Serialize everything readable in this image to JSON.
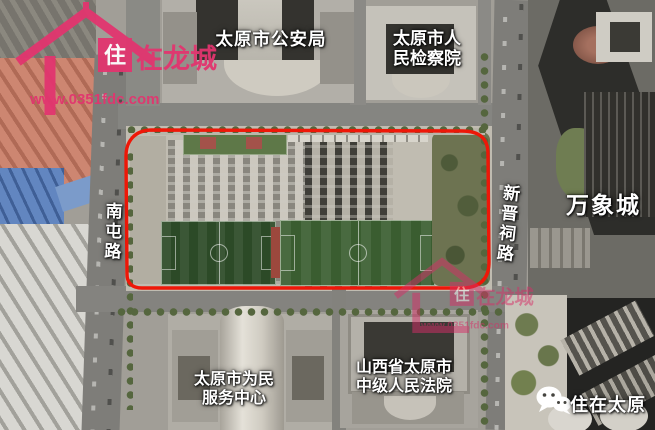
{
  "map": {
    "description": "satellite-view of Taiyuan land plot outlined in red",
    "labels": {
      "police_bureau": "太原市公安局",
      "procuratorate": [
        "太原市人",
        "民检察院"
      ],
      "wanxiang_city": "万象城",
      "xinjinci_road": "新晋祠路",
      "nantun_road": "南屯路",
      "service_center": [
        "太原市为民",
        "服务中心"
      ],
      "court": [
        "山西省太原市",
        "中级人民法院"
      ]
    },
    "watermarks": {
      "brand_char": "住",
      "brand_rest": "在龙城",
      "brand_url": "www.0351fdc.com",
      "wechat_account": "住在太原"
    },
    "colors": {
      "plot_outline_red": "#ee1708",
      "brand_pink": "#e2356f",
      "label_white": "#ffffff",
      "football_green": "#3a5d30",
      "parking_gray": "#c0bcb1"
    }
  }
}
